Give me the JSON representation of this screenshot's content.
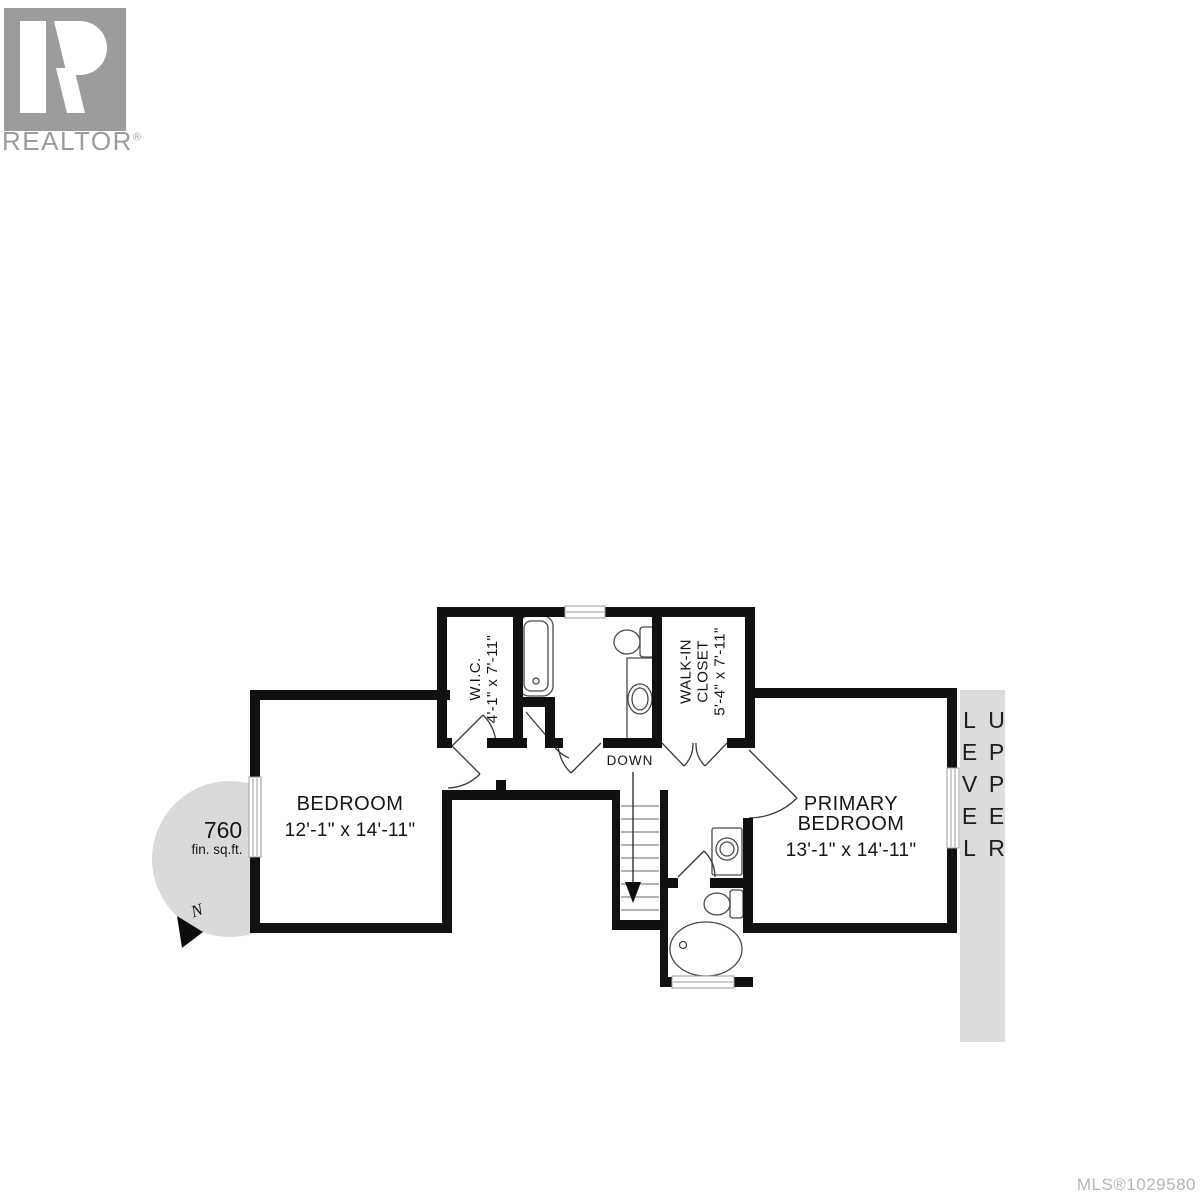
{
  "branding": {
    "logo_letter": "R",
    "logo_text": "REALTOR",
    "registered": "®"
  },
  "floor_plan": {
    "rooms": {
      "bedroom": {
        "name": "BEDROOM",
        "dims": "12'-1\" x 14'-11\""
      },
      "primary_bedroom": {
        "name": "PRIMARY BEDROOM",
        "dims": "13'-1\" x 14'-11\""
      },
      "wic": {
        "name": "W.I.C.",
        "dims": "4'-1\" x 7'-11\""
      },
      "walk_in_closet": {
        "line1": "WALK-IN",
        "line2": "CLOSET",
        "dims": "5'-4\" x 7'-11\""
      }
    },
    "stairs": {
      "label": "DOWN"
    },
    "area_badge": {
      "value": "760",
      "unit": "fin. sq.ft.",
      "north_letter": "N"
    }
  },
  "level_band": {
    "label": "UPPER LEVEL"
  },
  "footer": {
    "mls_number": "MLS®1029580"
  },
  "colors": {
    "wall": "#111111",
    "band_background": "#dcdcdc",
    "badge_background": "#dadada",
    "logo_gray": "#9c9c9c",
    "mls_gray": "#b5b5b5",
    "fixture_line": "#4a4a4a"
  }
}
